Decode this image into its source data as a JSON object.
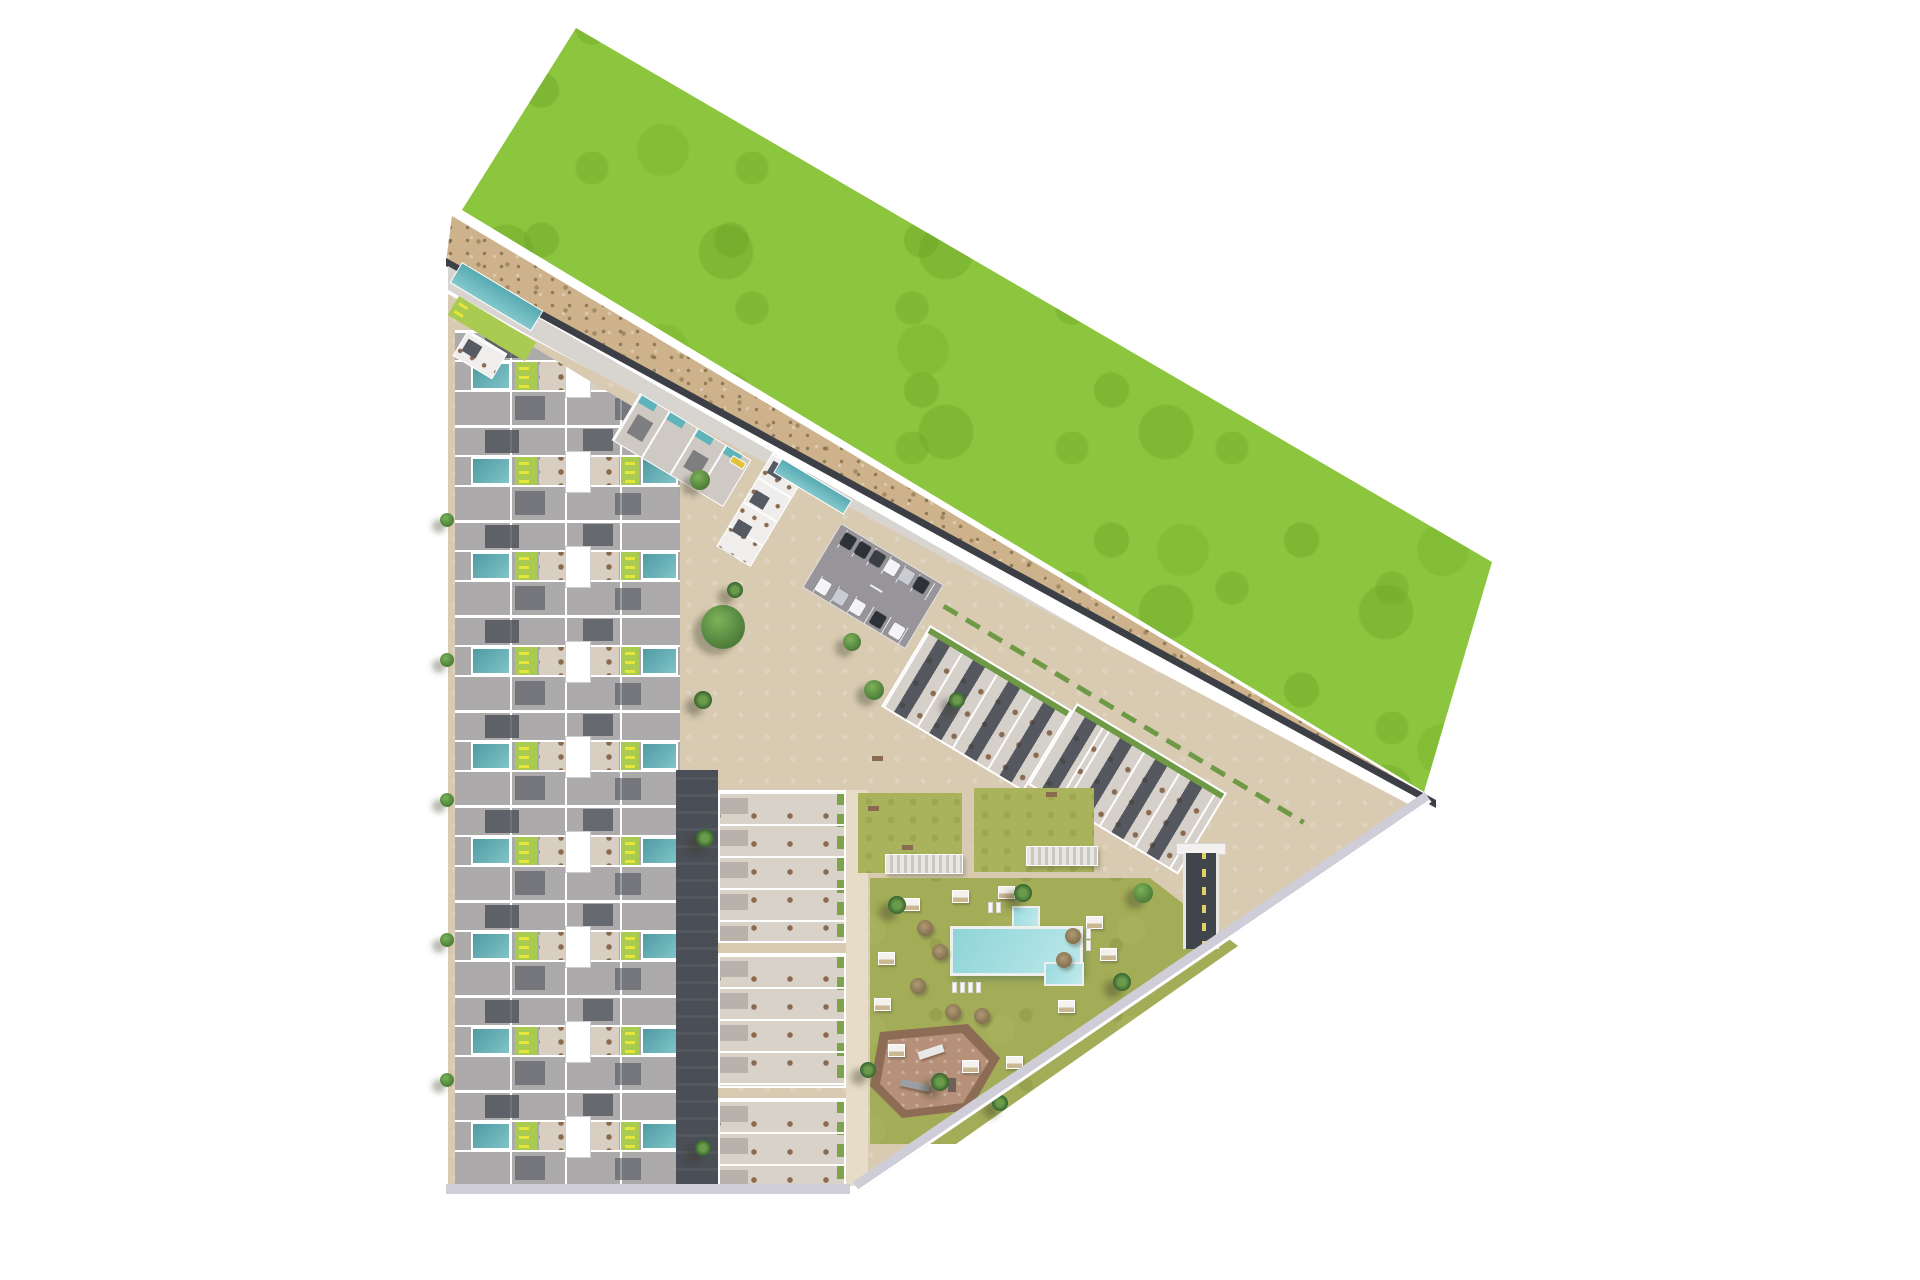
{
  "meta": {
    "title": "aerial-3d-site-plan-residential-development",
    "description": "Top-down 3D architectural rendering of a coastal residential development bounded by a large green field and dune strip on a white background. No text labels are rendered in the image.",
    "canvas": {
      "width": 1920,
      "height": 1280
    },
    "background": "#ffffff"
  },
  "palette": {
    "grass_field": "#8cc63f",
    "grass_mottle": "#6da626",
    "dune_sand": "#cdb28c",
    "dune_speckle": "#5d4e2d",
    "perimeter_road": "#d8d5d1",
    "road_edge_dark": "#3c4046",
    "site_paving": "#d8cbb2",
    "plaza_path": "#e6dcc8",
    "roof_gray": "#adaaac",
    "roof_dark": "#474c55",
    "terrace": "#d8cfc2",
    "wall_white": "#ffffff",
    "pool_teal": "#4f9aa2",
    "pool_light": "#8ed4d8",
    "lawn_strip_lime": "#a9cb52",
    "lounger_yellow": "#e6e63a",
    "amenity_lawn": "#a3ad57",
    "hedge_green": "#6f9a45",
    "playground_brown": "#b69079",
    "playground_border": "#8d6c56",
    "ramp_dark": "#40454c",
    "sidewalk_lavender": "#cfced8",
    "car_dark": "#2d3138",
    "car_white": "#f4f4f6",
    "car_silver": "#c9cdd2",
    "bus_yellow": "#e0c23c"
  },
  "areas": {
    "green_field": "undeveloped grass parcel (north-east)",
    "dune_strip": "sandy dune band with scrub between field and access road",
    "perimeter_road": "diagonal access road along the dune",
    "left_strip": "two facing rows of townhouses with private pools and roof terraces",
    "upper_cluster": "angled apartment block with communal lap pool",
    "parking": "surface parking lot with cars",
    "right_rows": "two angled rows of townhouses with roof terraces",
    "mid_column": "three apartment blocks with roof terraces",
    "amenity_garden": "communal lawn with swimming pool, cabanas and palms",
    "playground": "children's playground",
    "ramp": "underground parking ramp",
    "corner_amenity": "north-west corner lap pool and sun deck"
  },
  "scene": {
    "left_strip": {
      "x": 455,
      "y": 300,
      "module_count": 9,
      "module_pitch": 95,
      "width": 225
    },
    "mid_blocks": [
      {
        "x": 718,
        "y": 790,
        "w": 128,
        "h": 153
      },
      {
        "x": 718,
        "y": 953,
        "w": 128,
        "h": 135
      },
      {
        "x": 718,
        "y": 1098,
        "w": 128,
        "h": 90
      }
    ],
    "angled": {
      "upper_strip": {
        "x": 640,
        "y": 393,
        "w": 130,
        "h": 55,
        "angle": 31
      },
      "upper_block": {
        "x": 773,
        "y": 452,
        "w": 40,
        "h": 110,
        "angle": 31
      },
      "upper_block_pool": {
        "x": 782,
        "y": 458,
        "w": 82,
        "h": 17,
        "angle": 31
      },
      "corner_pool": {
        "x": 462,
        "y": 262,
        "w": 95,
        "h": 24,
        "angle": 31
      },
      "corner_deck": {
        "x": 459,
        "y": 296,
        "w": 90,
        "h": 22,
        "angle": 31
      },
      "corner_pavilion": {
        "x": 468,
        "y": 330,
        "w": 46,
        "h": 30,
        "angle": 31
      },
      "hedgerow": {
        "x": 945,
        "y": 604,
        "w": 420,
        "h": 5,
        "angle": 31
      }
    },
    "parking": {
      "x": 841,
      "y": 523,
      "w": 120,
      "h": 75,
      "angle": 31,
      "cars": [
        {
          "x": 8,
          "y": 4,
          "w": 13,
          "h": 14,
          "c": "#2d3138"
        },
        {
          "x": 25,
          "y": 4,
          "w": 13,
          "h": 14,
          "c": "#2d3138"
        },
        {
          "x": 42,
          "y": 4,
          "w": 13,
          "h": 14,
          "c": "#3a3f46"
        },
        {
          "x": 59,
          "y": 4,
          "w": 13,
          "h": 14,
          "c": "#f4f4f6"
        },
        {
          "x": 76,
          "y": 4,
          "w": 13,
          "h": 14,
          "c": "#c9cdd2"
        },
        {
          "x": 93,
          "y": 4,
          "w": 13,
          "h": 14,
          "c": "#2d3138"
        },
        {
          "x": 10,
          "y": 56,
          "w": 13,
          "h": 14,
          "c": "#f4f4f6"
        },
        {
          "x": 30,
          "y": 56,
          "w": 13,
          "h": 14,
          "c": "#c9cdd2"
        },
        {
          "x": 50,
          "y": 56,
          "w": 13,
          "h": 14,
          "c": "#f4f4f6"
        },
        {
          "x": 74,
          "y": 56,
          "w": 13,
          "h": 14,
          "c": "#2d3138"
        },
        {
          "x": 96,
          "y": 56,
          "w": 13,
          "h": 14,
          "c": "#f4f4f6"
        }
      ]
    },
    "right_rows": [
      {
        "x": 930,
        "y": 625,
        "w": 166,
        "h": 95,
        "angle": 31,
        "units": 4
      },
      {
        "x": 1077,
        "y": 703,
        "w": 175,
        "h": 95,
        "angle": 31,
        "units": 4
      }
    ],
    "bus": {
      "x": 733,
      "y": 455,
      "w": 16,
      "h": 8,
      "angle": 31
    },
    "lawn_patches": [
      {
        "x": 858,
        "y": 793,
        "w": 104,
        "h": 80
      },
      {
        "x": 974,
        "y": 788,
        "w": 120,
        "h": 84
      }
    ],
    "pergolas": [
      {
        "x": 885,
        "y": 854,
        "w": 78,
        "h": 20
      },
      {
        "x": 1026,
        "y": 846,
        "w": 72,
        "h": 20
      }
    ],
    "pool": {
      "main": {
        "x": 950,
        "y": 926,
        "w": 133,
        "h": 50
      },
      "spa": {
        "x": 1012,
        "y": 906,
        "w": 28,
        "h": 22
      },
      "steps": {
        "x": 1044,
        "y": 962,
        "w": 40,
        "h": 24
      }
    },
    "plaza_paths": [
      {
        "x": 846,
        "y": 790,
        "w": 22,
        "h": 396
      }
    ],
    "cabanas": [
      [
        903,
        898
      ],
      [
        952,
        890
      ],
      [
        998,
        886
      ],
      [
        878,
        952
      ],
      [
        874,
        998
      ],
      [
        888,
        1044
      ],
      [
        1086,
        916
      ],
      [
        1100,
        948
      ],
      [
        1058,
        1000
      ],
      [
        962,
        1060
      ],
      [
        1006,
        1056
      ]
    ],
    "umbrellas": [
      [
        925,
        928
      ],
      [
        940,
        952
      ],
      [
        1073,
        936
      ],
      [
        1064,
        960
      ],
      [
        953,
        1012
      ],
      [
        982,
        1016
      ],
      [
        918,
        986
      ]
    ],
    "loungers": [
      [
        952,
        982
      ],
      [
        960,
        982
      ],
      [
        968,
        982
      ],
      [
        976,
        982
      ],
      [
        1086,
        928
      ],
      [
        1086,
        940
      ],
      [
        988,
        902
      ],
      [
        996,
        902
      ]
    ],
    "benches": [
      [
        872,
        756
      ],
      [
        868,
        806
      ],
      [
        1046,
        792
      ],
      [
        902,
        845
      ]
    ],
    "round_trees": [
      [
        723,
        627,
        22
      ],
      [
        700,
        480,
        10
      ],
      [
        874,
        690,
        10
      ],
      [
        852,
        642,
        9
      ],
      [
        1143,
        893,
        10
      ],
      [
        447,
        520,
        7
      ],
      [
        447,
        660,
        7
      ],
      [
        447,
        800,
        7
      ],
      [
        447,
        940,
        7
      ],
      [
        447,
        1080,
        7
      ]
    ],
    "palm_trees": [
      [
        897,
        905,
        9
      ],
      [
        1023,
        893,
        9
      ],
      [
        940,
        1082,
        9
      ],
      [
        1000,
        1103,
        8
      ],
      [
        1122,
        982,
        9
      ],
      [
        868,
        1070,
        8
      ],
      [
        957,
        700,
        8
      ],
      [
        703,
        700,
        9
      ],
      [
        705,
        838,
        9
      ],
      [
        703,
        1148,
        8
      ],
      [
        735,
        590,
        8
      ]
    ]
  }
}
